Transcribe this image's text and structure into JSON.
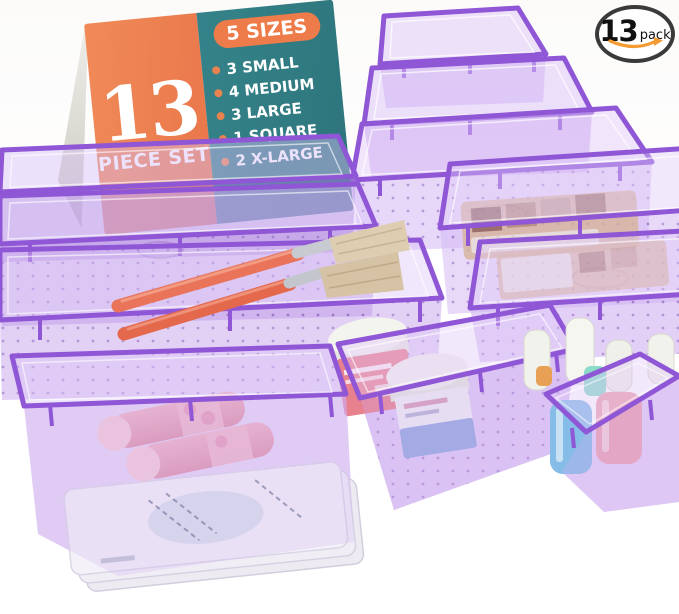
{
  "card": {
    "piece_count": "13",
    "piece_label": "PIECE SET",
    "sizes_title": "5 SIZES",
    "sizes": [
      "3 SMALL",
      "4 MEDIUM",
      "3 LARGE",
      "1 SQUARE",
      "2 X-LARGE"
    ],
    "colors": {
      "left_panel": "#EE7B4A",
      "right_panel": "#2F7A7E",
      "pill": "#EE7B4A",
      "text": "#FFFFFF",
      "bullet": "#E8824E",
      "spine": "#D8D6D0"
    }
  },
  "badge": {
    "count": "13",
    "unit": "pack",
    "border_color": "#3A3A3A",
    "swoosh_color": "#F49B32"
  },
  "scene": {
    "product": "transparent purple drawer organizer trays",
    "tray_fill_color": "#C3A0EC",
    "tray_rim_color": "#8F56D6",
    "floor_dot_color": "#7B4FB0",
    "tray_count": 11,
    "props": {
      "makeup_brushes": 2,
      "lipsticks": 2,
      "cream_jars": 2,
      "nail_polish_bottles": 4,
      "eyeshadow_palettes": 2,
      "sheet_masks": 3
    }
  }
}
